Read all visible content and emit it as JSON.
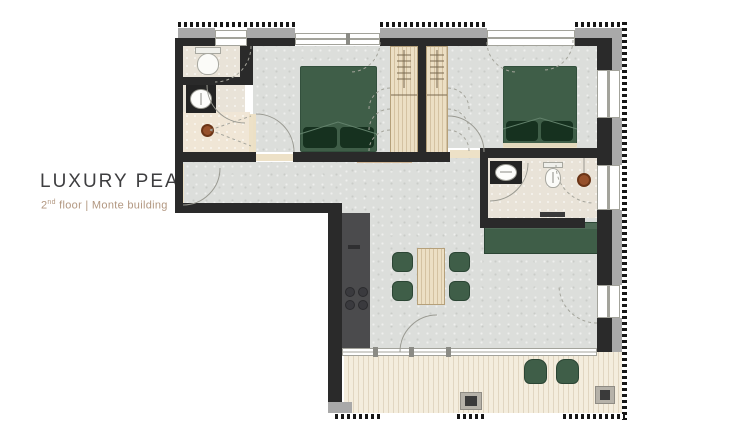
{
  "title": {
    "label": "LUXURY PEAK",
    "arrow": "▶"
  },
  "subtitle": {
    "floor_number": "2",
    "floor_ordinal": "nd",
    "text_after": " floor | Monte building"
  },
  "colors": {
    "wall": "#2a2a2a",
    "floor": "#dcdedb",
    "floor_bath": "#e9e3d8",
    "terrace": "#f4eddd",
    "wood": "#ecdfc4",
    "wood_dark": "#b5a07a",
    "green": "#3f5e48",
    "green_dark": "#2b4534",
    "pillow": "#16311f",
    "ext": "#a9a9a9",
    "counter": "#4b4b4d",
    "copper": "#96502b",
    "line": "#9a9a92",
    "title_text": "#3e3e40",
    "subtitle_text": "#b29780"
  }
}
